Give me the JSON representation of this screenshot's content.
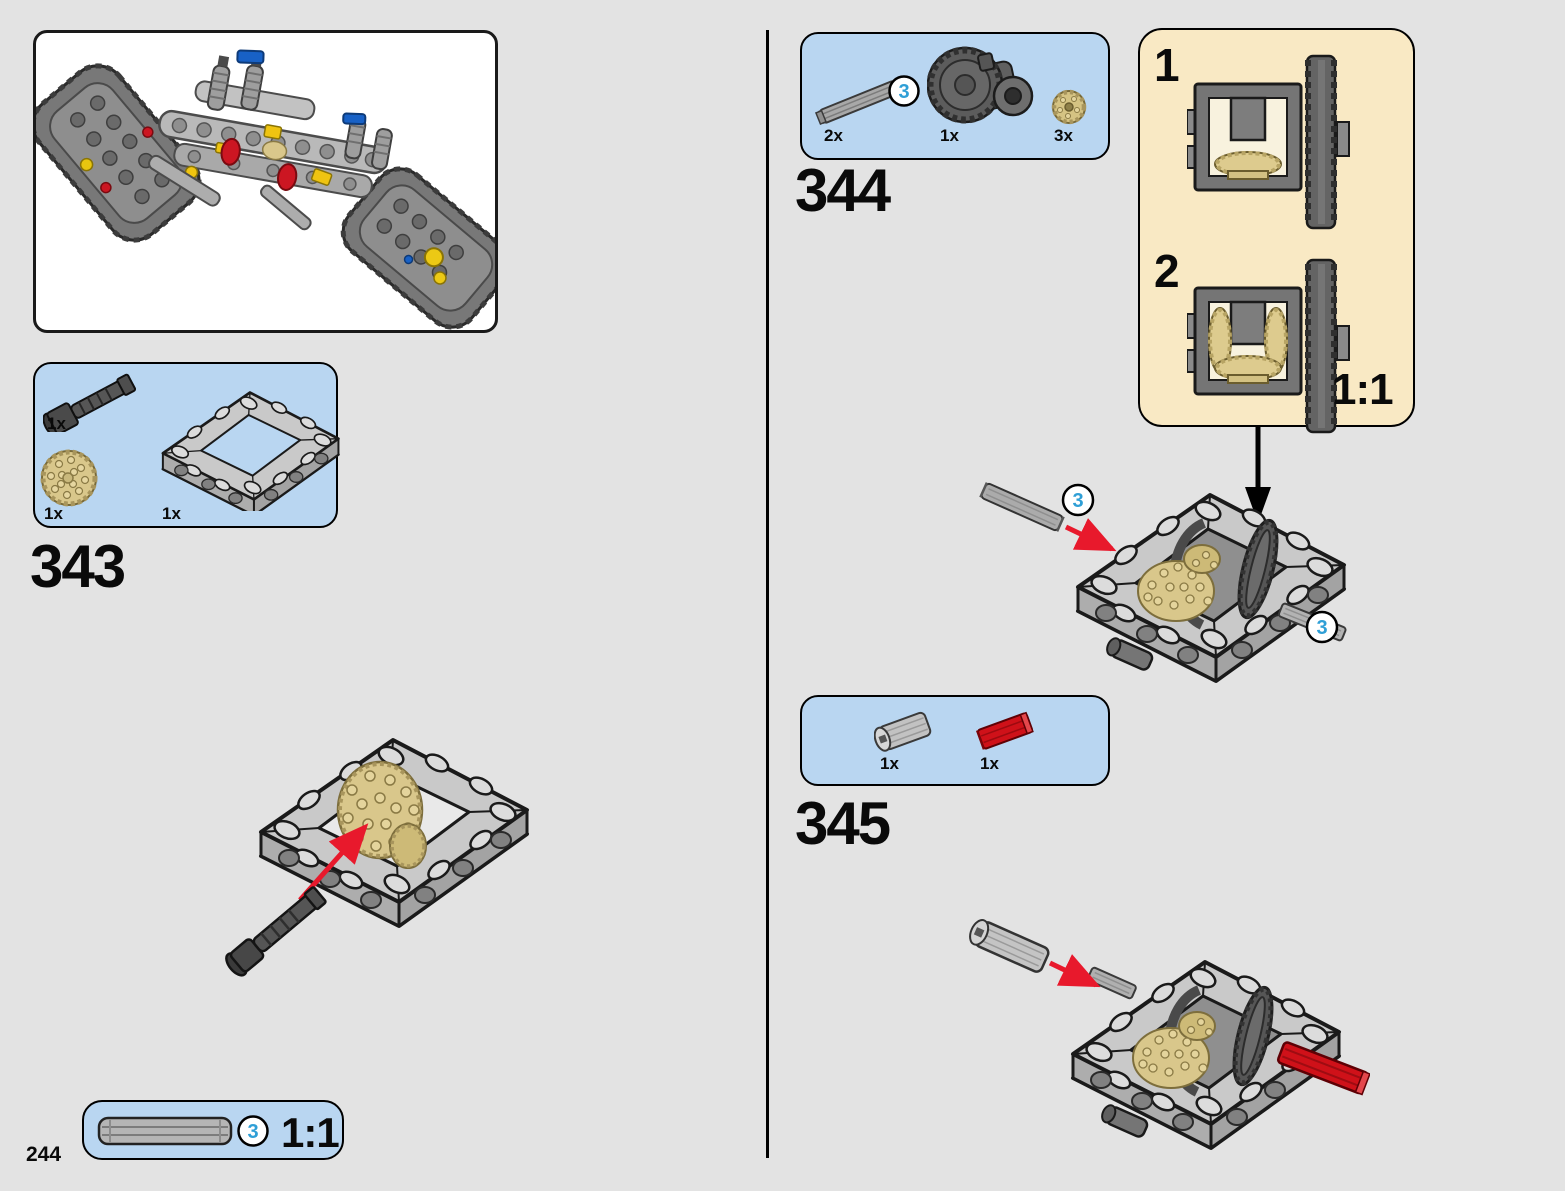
{
  "page": {
    "number": "244",
    "background": "#e3e3e3"
  },
  "colors": {
    "parts_box_bg": "#b9d6f1",
    "scale_box_bg": "#f9e9c4",
    "box_border": "#000000",
    "callout_blue": "#2f9fd6",
    "arrow_red": "#e8192c",
    "lego_tan": "#d9c78b",
    "lego_red": "#cf1119",
    "lego_gray": "#c6c6c6",
    "lego_dark_gray": "#5a5a5a"
  },
  "preview": {
    "alt": "partially-built tracked chassis"
  },
  "steps": {
    "s343": {
      "label": "343",
      "parts": [
        {
          "qty": "1x",
          "name": "axle-pin-with-bush"
        },
        {
          "qty": "1x",
          "name": "knob-gear-tan"
        },
        {
          "qty": "1x",
          "name": "technic-frame-5x7"
        }
      ]
    },
    "s344": {
      "label": "344",
      "parts": [
        {
          "qty": "2x",
          "name": "axle-3l",
          "length_callout": "3"
        },
        {
          "qty": "1x",
          "name": "differential-housing"
        },
        {
          "qty": "3x",
          "name": "bevel-gear-12t-tan"
        }
      ]
    },
    "s345": {
      "label": "345",
      "parts": [
        {
          "qty": "1x",
          "name": "axle-connector-2l"
        },
        {
          "qty": "1x",
          "name": "axle-2l-red"
        }
      ]
    }
  },
  "scale_box": {
    "substeps": [
      "1",
      "2"
    ],
    "scale_label": "1:1"
  },
  "axle_scale_box": {
    "callout": "3",
    "scale_label": "1:1"
  },
  "assembly_callouts": {
    "s344_left": "3",
    "s344_right": "3"
  }
}
